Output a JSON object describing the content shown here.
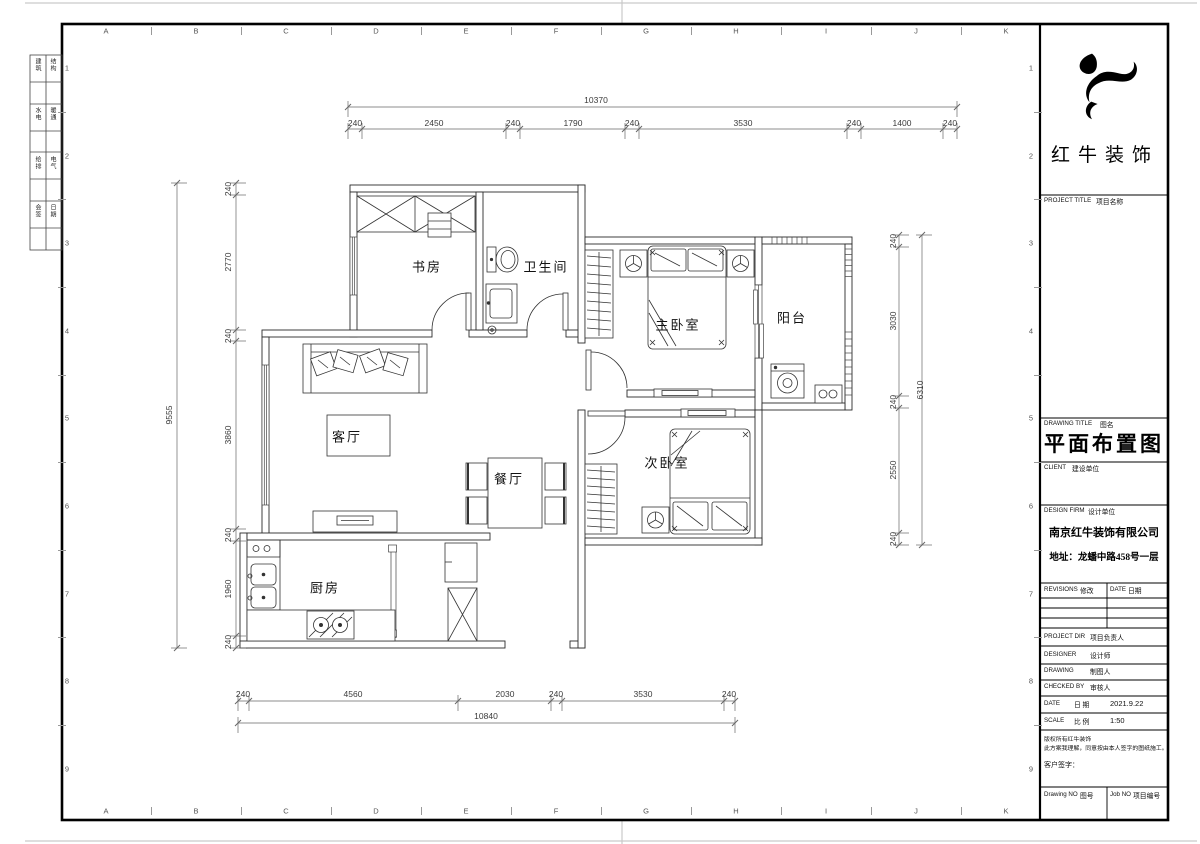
{
  "sheet": {
    "grid_letters": [
      "A",
      "B",
      "C",
      "D",
      "E",
      "F",
      "G",
      "H",
      "I",
      "J",
      "K"
    ],
    "row_numbers": [
      "1",
      "2",
      "3",
      "4",
      "5",
      "6",
      "7",
      "8",
      "9"
    ]
  },
  "side_table": {
    "rows": [
      [
        "建筑",
        "结构"
      ],
      [
        "水电",
        "暖通"
      ],
      [
        "给排",
        "电气"
      ],
      [
        "会签",
        "日期"
      ]
    ]
  },
  "title_block": {
    "logo_text": "红牛装饰",
    "project_title_label": "PROJECT TITLE",
    "project_title_cn": "项目名称",
    "drawing_title_label": "DRAWING TITLE",
    "drawing_title_cn": "图名",
    "drawing_title": "平面布置图",
    "client_label": "CLIENT",
    "client_cn": "建设单位",
    "design_firm_label": "DESIGN FIRM",
    "design_firm_cn": "设计单位",
    "company": "南京红牛装饰有限公司",
    "address": "地址：龙蟠中路458号一层",
    "revisions_label": "REVISIONS",
    "revisions_cn": "修改",
    "date_label": "DATE",
    "date_cn": "日期",
    "project_dir_label": "PROJECT DIR",
    "project_dir_cn": "项目负责人",
    "designer_label": "DESIGNER",
    "designer_cn": "设计师",
    "drawing_label": "DRAWING",
    "drawing_cn": "制图人",
    "checked_label": "CHECKED BY",
    "checked_cn": "审核人",
    "date_row_label": "DATE",
    "date_row_cn": "日 期",
    "date_value": "2021.9.22",
    "scale_label": "SCALE",
    "scale_cn": "比 例",
    "scale_value": "1:50",
    "copyright_line1": "版权所有红牛装饰",
    "copyright_line2": "此方案我理解，同意按由本人签字的图纸施工。",
    "customer_sign": "客户签字：",
    "drawing_no_label": "Drawing NO",
    "drawing_no_cn": "图号",
    "job_no_label": "Job NO",
    "job_no_cn": "项目编号"
  },
  "floorplan": {
    "rooms": [
      {
        "t": "书房",
        "x": 427,
        "y": 266
      },
      {
        "t": "卫生间",
        "x": 546,
        "y": 266
      },
      {
        "t": "主卧室",
        "x": 678,
        "y": 324
      },
      {
        "t": "阳台",
        "x": 792,
        "y": 317
      },
      {
        "t": "客厅",
        "x": 347,
        "y": 436
      },
      {
        "t": "餐厅",
        "x": 509,
        "y": 478
      },
      {
        "t": "次卧室",
        "x": 667,
        "y": 462
      },
      {
        "t": "厨房",
        "x": 325,
        "y": 587
      }
    ],
    "dimensions": [
      {
        "t": "10370",
        "x": 596,
        "y": 100
      },
      {
        "t": "240",
        "x": 355,
        "y": 123
      },
      {
        "t": "2450",
        "x": 434,
        "y": 123
      },
      {
        "t": "240",
        "x": 513,
        "y": 123
      },
      {
        "t": "1790",
        "x": 573,
        "y": 123
      },
      {
        "t": "240",
        "x": 632,
        "y": 123
      },
      {
        "t": "3530",
        "x": 743,
        "y": 123
      },
      {
        "t": "240",
        "x": 854,
        "y": 123
      },
      {
        "t": "1400",
        "x": 902,
        "y": 123
      },
      {
        "t": "240",
        "x": 950,
        "y": 123
      },
      {
        "t": "9555",
        "x": 169,
        "y": 415,
        "v": true
      },
      {
        "t": "240",
        "x": 228,
        "y": 189,
        "v": true
      },
      {
        "t": "2770",
        "x": 228,
        "y": 262,
        "v": true
      },
      {
        "t": "240",
        "x": 228,
        "y": 336,
        "v": true
      },
      {
        "t": "3860",
        "x": 228,
        "y": 435,
        "v": true
      },
      {
        "t": "240",
        "x": 228,
        "y": 535,
        "v": true
      },
      {
        "t": "1960",
        "x": 228,
        "y": 589,
        "v": true
      },
      {
        "t": "240",
        "x": 228,
        "y": 642,
        "v": true
      },
      {
        "t": "240",
        "x": 893,
        "y": 241,
        "v": true
      },
      {
        "t": "3030",
        "x": 893,
        "y": 321,
        "v": true
      },
      {
        "t": "240",
        "x": 893,
        "y": 402,
        "v": true
      },
      {
        "t": "2550",
        "x": 893,
        "y": 470,
        "v": true
      },
      {
        "t": "240",
        "x": 893,
        "y": 539,
        "v": true
      },
      {
        "t": "6310",
        "x": 920,
        "y": 390,
        "v": true
      },
      {
        "t": "240",
        "x": 243,
        "y": 694
      },
      {
        "t": "4560",
        "x": 353,
        "y": 694
      },
      {
        "t": "2030",
        "x": 505,
        "y": 694
      },
      {
        "t": "240",
        "x": 556,
        "y": 694
      },
      {
        "t": "3530",
        "x": 643,
        "y": 694
      },
      {
        "t": "240",
        "x": 729,
        "y": 694
      },
      {
        "t": "10840",
        "x": 486,
        "y": 716
      }
    ]
  }
}
